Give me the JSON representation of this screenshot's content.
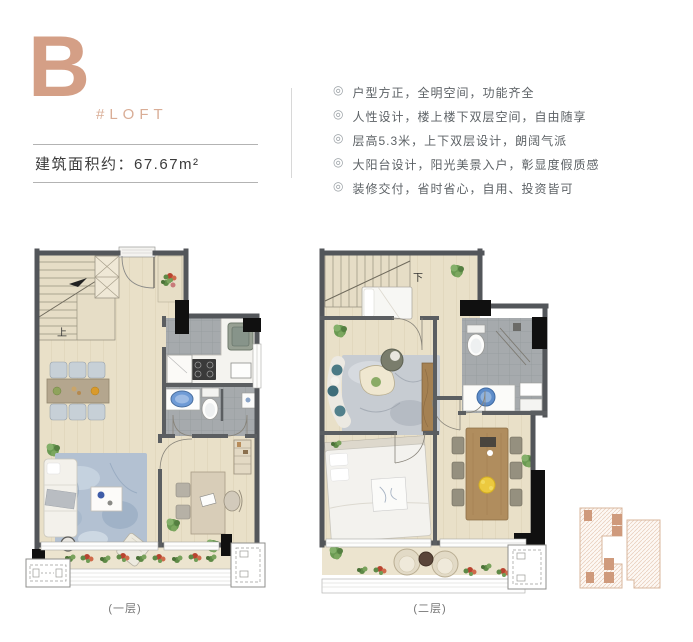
{
  "unit": {
    "letter": "B",
    "tag": "#LOFT",
    "area": "建筑面积约：67.67m²"
  },
  "features": {
    "bullet": "◎",
    "items": [
      "户型方正，全明空间，功能齐全",
      "人性设计，楼上楼下双层空间，自由随享",
      "层高5.3米，上下双层设计，朗阔气派",
      "大阳台设计，阳光美景入户，彰显度假质感",
      "装修交付，省时省心，自用、投资皆可"
    ]
  },
  "plans": {
    "first": {
      "stair_label": "上",
      "caption": "(一层)"
    },
    "second": {
      "stair_label": "下",
      "caption": "(二层)"
    }
  },
  "colors": {
    "accent": "#d49f86",
    "wall": "#54575a",
    "wood_floor": "#e9e0c8",
    "tile": "#a6aaad",
    "rug_blue": "#b3c1d2"
  }
}
